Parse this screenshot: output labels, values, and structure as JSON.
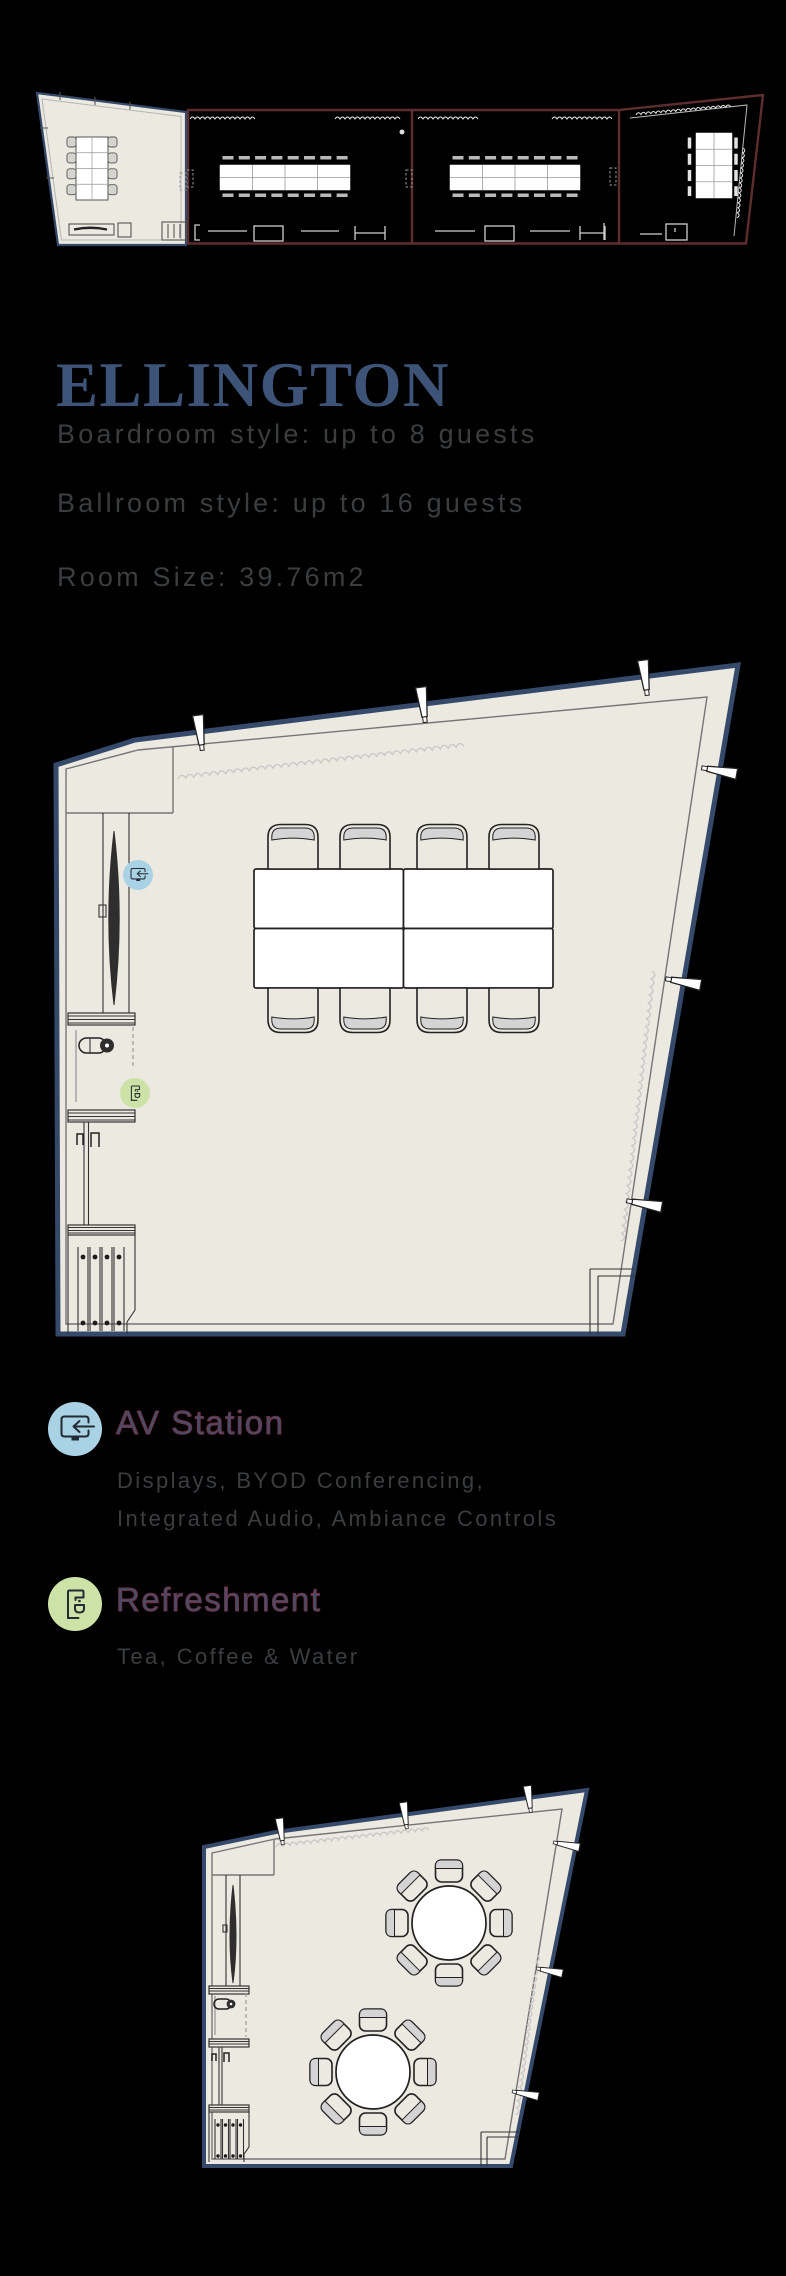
{
  "page": {
    "background": "#000000"
  },
  "room": {
    "title": "ELLINGTON",
    "specs": [
      "Boardroom style: up to 8 guests",
      "Ballroom style: up to 16 guests",
      "Room Size: 39.76m2"
    ]
  },
  "legend": [
    {
      "heading": "AV Station",
      "description_lines": [
        "Displays, BYOD Conferencing,",
        "Integrated Audio, Ambiance Controls"
      ],
      "badge_color": "#a9d2e4",
      "icon": "av-monitor-icon"
    },
    {
      "heading": "Refreshment",
      "description_lines": [
        "Tea, Coffee & Water"
      ],
      "badge_color": "#cde2a7",
      "icon": "coffee-machine-icon"
    }
  ],
  "plans": {
    "overview": {
      "rooms_shown": 4,
      "highlighted_room_seats": 8
    },
    "boardroom_plan": {
      "seats": 8,
      "table_sections": 4,
      "markers": [
        "AV Station",
        "Refreshment"
      ]
    },
    "ballroom_plan": {
      "round_tables": 2,
      "seats_per_table": 8
    }
  },
  "colors": {
    "title": "#3d5377",
    "text_gray": "#3b3e41",
    "heading_fill": "#44506b",
    "heading_stroke": "#6e3246",
    "plan_fill": "#ebe9e0",
    "navy": "#35496b",
    "maroon": "#5e2d2d",
    "inner_wall": "#757575",
    "light_line": "#a8a8a8",
    "curtain": "#c9c9c9",
    "band": "#d4d4d4",
    "badge_blue": "#a9d2e4",
    "badge_green": "#cde2a7",
    "icon_dark": "#222b33"
  }
}
